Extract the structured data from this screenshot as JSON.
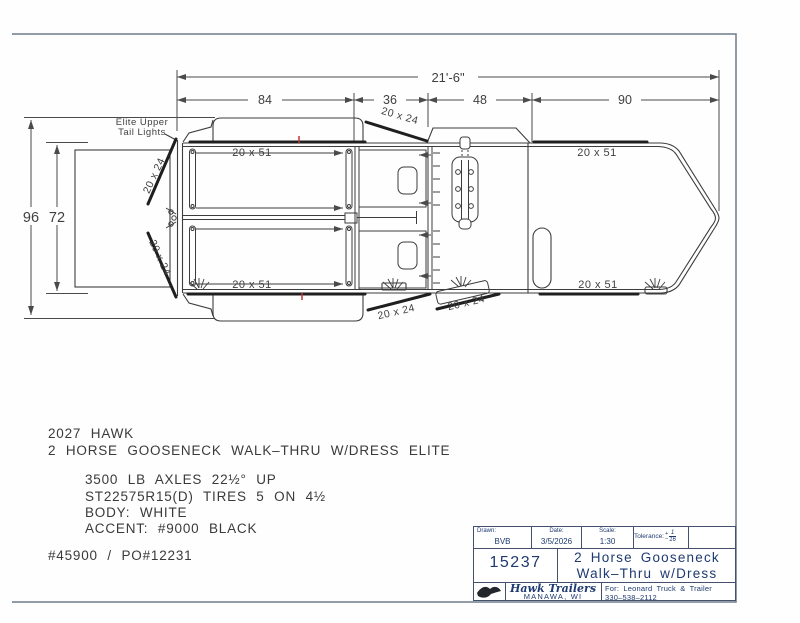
{
  "dimensions": {
    "overall_length": "21'-6\"",
    "sections": [
      "84",
      "36",
      "48",
      "90"
    ],
    "overall_width": "96",
    "rear_opening_width": "72"
  },
  "labels": {
    "window": "20 x 51",
    "door": "20 x 24",
    "tail_lights_1": "Elite Upper",
    "tail_lights_2": "Tail Lights"
  },
  "notes": {
    "model_year_line": "2027 HAWK",
    "model_line": "2 HORSE GOOSENECK WALK–THRU W/DRESS ELITE",
    "specs": [
      "3500 LB AXLES 22½° UP",
      "ST22575R15(D) TIRES 5 ON 4½",
      "BODY: WHITE",
      "ACCENT: #9000 BLACK"
    ],
    "order_line": "#45900 / PO#12231"
  },
  "title_block": {
    "drawn_label": "Drawn:",
    "drawn": "BVB",
    "date_label": "Date:",
    "date": "3/5/2026",
    "scale_label": "Scale:",
    "scale": "1:30",
    "tolerance_label": "Tolerance:",
    "tolerance_plus": "+",
    "tolerance_minus": "−",
    "tolerance_numerator": "1",
    "tolerance_denominator": "16",
    "number": "15237",
    "title_line1": "2 Horse Gooseneck",
    "title_line2": "Walk–Thru w/Dress",
    "company": "Hawk Trailers",
    "city": "MANAWA, WI",
    "for_line1": "For: Leonard Truck & Trailer",
    "phone": "330–538–2112"
  },
  "colors": {
    "line": "#3c3c3c",
    "thick_line": "#1f1f1f",
    "border": "#6e7b8a",
    "title_navy": "#1e3a70",
    "red_mark": "#c03535"
  }
}
